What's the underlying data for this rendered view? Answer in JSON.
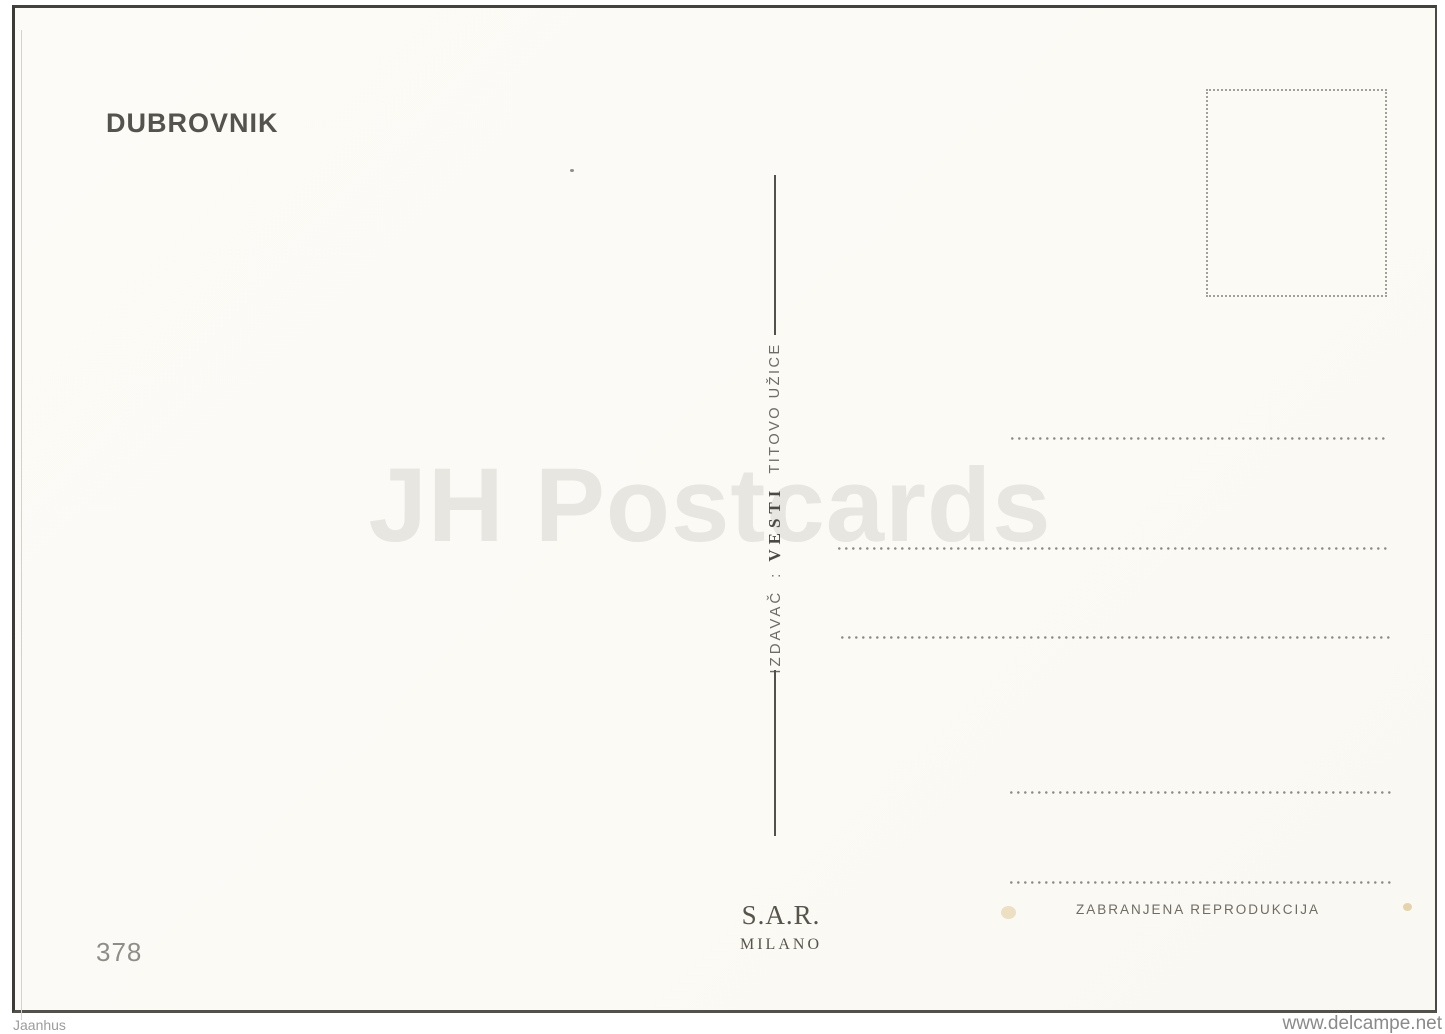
{
  "postcard": {
    "title": "DUBROVNIK",
    "number": "378",
    "publisher_line": {
      "label": "IZDAVAČ",
      "separator": ":",
      "name": "VESTI",
      "location": "TITOVO UŽICE"
    },
    "printer": {
      "name": "S.A.R.",
      "city": "MILANO"
    },
    "reproduction_notice": "ZABRANJENA REPRODUKCIJA"
  },
  "watermark": "JH Postcards",
  "footer": {
    "seller": "Jaanhus",
    "site": "www.delcampe.net"
  },
  "colors": {
    "card_background": "#fbfaf5",
    "edge_ink": "#43423e",
    "title_ink": "#54534d",
    "imprint_ink": "#6e6c65",
    "printer_ink": "#57544b",
    "dotted_line": "#8b8a83",
    "stamp_box_border": "#a3a098",
    "watermark_gray": "#e7e6e1",
    "footer_gray": "#8f8f8f"
  }
}
